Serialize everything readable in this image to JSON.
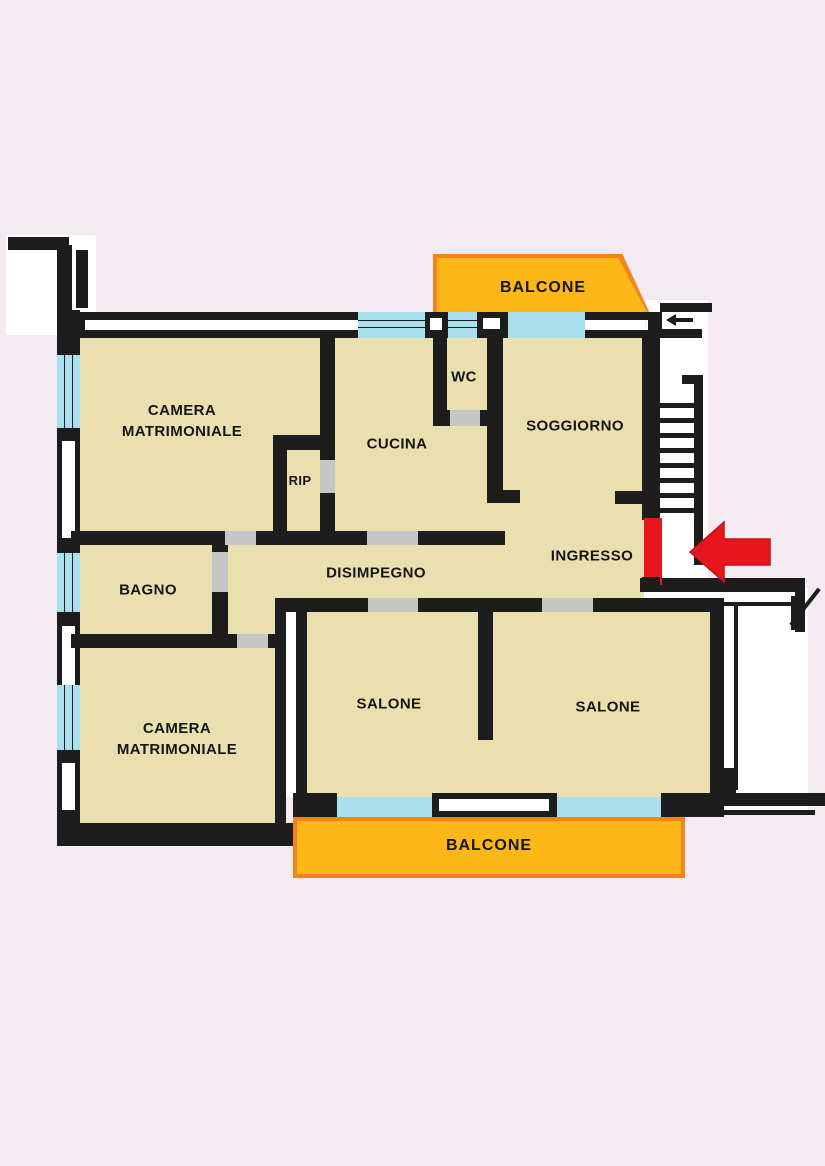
{
  "title": "Planimetria appartamento - floor plan",
  "colors": {
    "bg": "#f4eaf2",
    "paper": "#ffffff",
    "wall": "#1d1d1d",
    "room": "#eadfae",
    "window": "#aadfee",
    "door": "#c6c6c6",
    "balcony": "#fdb717",
    "balcony_border": "#f5821f",
    "red": "#e8151d",
    "text": "#161616"
  },
  "labels": {
    "camera_matrimoniale_1": {
      "line1": "CAMERA",
      "line2": "MATRIMONIALE"
    },
    "cucina": "CUCINA",
    "wc": "WC",
    "soggiorno": "SOGGIORNO",
    "rip": "RIP",
    "bagno": "BAGNO",
    "disimpegno": "DISIMPEGNO",
    "ingresso": "INGRESSO",
    "camera_matrimoniale_2": {
      "line1": "CAMERA",
      "line2": "MATRIMONIALE"
    },
    "salone_left": "SALONE",
    "salone_right": "SALONE",
    "balcone_top": "BALCONE",
    "balcone_bottom": "BALCONE"
  },
  "icons": {
    "entrance_arrow": "red-left-arrow-icon",
    "entrance_door": "red-door-marker",
    "stairs": "staircase",
    "windows": "cyan-window-bands",
    "doors": "gray-door-gaps"
  }
}
